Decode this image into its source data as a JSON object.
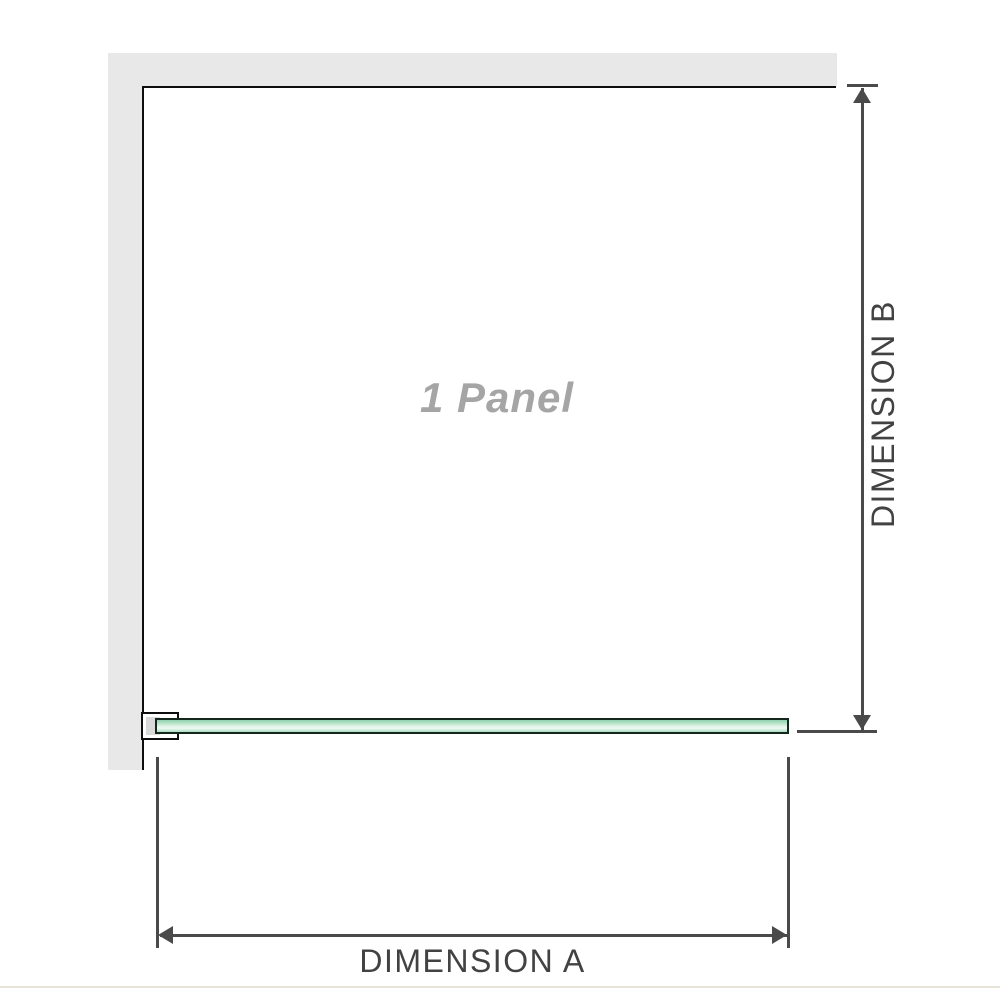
{
  "panel": {
    "label": "1 Panel"
  },
  "dimensions": {
    "a": {
      "label": "DIMENSION A"
    },
    "b": {
      "label": "DIMENSION B"
    }
  },
  "colors": {
    "background": "#ffffff",
    "wall_fill": "#e8e8e8",
    "outline": "#0d0d0d",
    "dimension_line": "#4a4a4a",
    "dimension_text": "#424242",
    "panel_label_text": "#a5a5a5",
    "glass_border": "#14271c",
    "glass_green_dark": "#8fd0ae",
    "glass_green_light": "#eef9f2",
    "glass_green_mid": "#a9dcc2",
    "clamp_inner": "#d9d9d9",
    "floor_line": "#e8e3d9"
  }
}
